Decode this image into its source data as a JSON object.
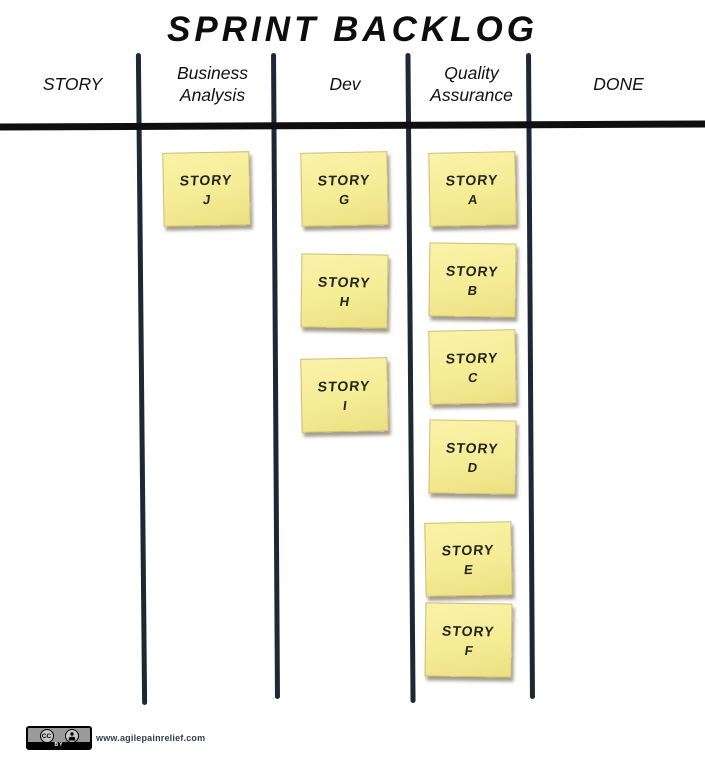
{
  "title": "SPRINT BACKLOG",
  "board": {
    "columns": [
      {
        "id": "story",
        "label": "STORY",
        "notes": []
      },
      {
        "id": "ba",
        "label": "Business\nAnalysis",
        "notes": [
          {
            "title": "STORY",
            "letter": "J"
          }
        ]
      },
      {
        "id": "dev",
        "label": "Dev",
        "notes": [
          {
            "title": "STORY",
            "letter": "G"
          },
          {
            "title": "STORY",
            "letter": "H"
          },
          {
            "title": "STORY",
            "letter": "I"
          }
        ]
      },
      {
        "id": "qa",
        "label": "Quality\nAssurance",
        "notes": [
          {
            "title": "STORY",
            "letter": "A"
          },
          {
            "title": "STORY",
            "letter": "B"
          },
          {
            "title": "STORY",
            "letter": "C"
          },
          {
            "title": "STORY",
            "letter": "D"
          },
          {
            "title": "STORY",
            "letter": "E"
          },
          {
            "title": "STORY",
            "letter": "F"
          }
        ]
      },
      {
        "id": "done",
        "label": "DONE",
        "notes": []
      }
    ]
  },
  "footer": {
    "cc_label": "CC",
    "cc_by": "BY",
    "website": "www.agilepainrelief.com"
  },
  "colors": {
    "note_bg": "#f5ec96",
    "note_border": "#cdbd6d",
    "grid_line_navy": "#1d2735",
    "rule_black": "#0f0f0f"
  }
}
